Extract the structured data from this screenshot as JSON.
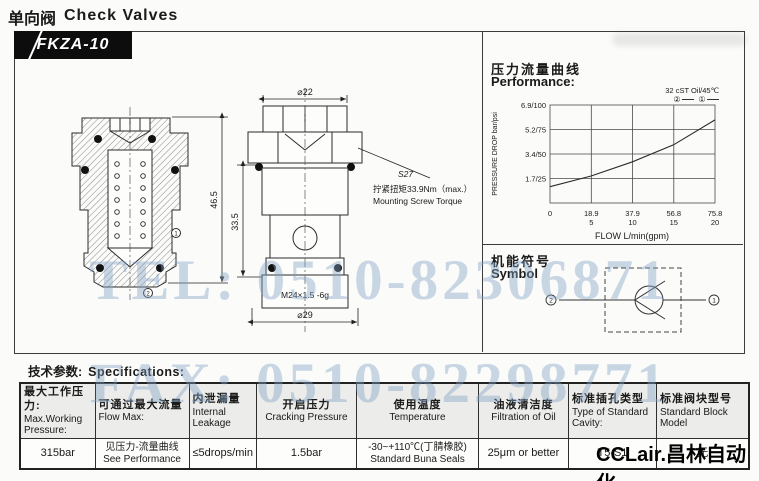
{
  "page": {
    "title_zh": "单向阀",
    "title_en": "Check Valves",
    "model": "FKZA-10"
  },
  "watermarks": {
    "tel": "TEL: 0510-82306871",
    "fax": "FAX: 0510-82298771",
    "color": "#80a3c5"
  },
  "logo_text": "CCLair.昌林自动化",
  "drawing": {
    "dim_dia_top": "⌀22",
    "dim_overall_height": "46.5",
    "dim_body_height": "33.5",
    "dim_thread": "M24×1.5 -6g",
    "dim_dia_bottom": "⌀29",
    "wrench_size": "S27",
    "torque_zh": "拧紧扭矩33.9Nm（max.）",
    "torque_en": "Mounting Screw Torque",
    "port1": "1",
    "port2": "2"
  },
  "performance": {
    "title_zh": "压力流量曲线",
    "title_en": "Performance:"
  },
  "chart_data": {
    "type": "line",
    "title": "32 cST Oil/45℃",
    "legend": [
      {
        "name": "②"
      },
      {
        "name": "①"
      }
    ],
    "xlabel": "FLOW L/min(gpm)",
    "ylabel": "PRESSURE DROP bar/psi",
    "xlim": [
      0,
      75.8
    ],
    "ylim": [
      0,
      6.9
    ],
    "grid": true,
    "y_ticks": [
      "6.9/100",
      "5.2/75",
      "3.4/50",
      "1.7/25"
    ],
    "x_ticks": [
      {
        "lmin": "0",
        "gpm": ""
      },
      {
        "lmin": "18.9",
        "gpm": "5"
      },
      {
        "lmin": "37.9",
        "gpm": "10"
      },
      {
        "lmin": "56.8",
        "gpm": "15"
      },
      {
        "lmin": "75.8",
        "gpm": "20"
      }
    ],
    "series": [
      {
        "name": "①②",
        "points": [
          [
            0,
            1.15
          ],
          [
            18.9,
            1.9
          ],
          [
            37.9,
            2.9
          ],
          [
            56.8,
            4.1
          ],
          [
            75.8,
            5.85
          ]
        ]
      }
    ]
  },
  "symbol": {
    "title_zh": "机能符号",
    "title_en": "Symbol",
    "port_left": "2",
    "port_right": "1"
  },
  "specs": {
    "heading_zh": "技术参数:",
    "heading_en": "Specifications:",
    "columns": [
      {
        "zh": "最大工作压力:",
        "en": "Max.Working Pressure:"
      },
      {
        "zh": "可通过最大流量",
        "en": "Flow Max:"
      },
      {
        "zh": "内泄漏量",
        "en": "Internal Leakage"
      },
      {
        "zh": "开启压力",
        "en": "Cracking Pressure"
      },
      {
        "zh": "使用温度",
        "en": "Temperature"
      },
      {
        "zh": "油液清洁度",
        "en": "Filtration of Oil"
      },
      {
        "zh": "标准插孔类型",
        "en": "Type of Standard Cavity:"
      },
      {
        "zh": "标准阀块型号",
        "en": "Standard Block Model"
      }
    ],
    "values": [
      {
        "line1": "315bar",
        "line2": ""
      },
      {
        "line1": "见压力-流量曲线",
        "line2": "See Performance"
      },
      {
        "line1": "≤5drops/min",
        "line2": ""
      },
      {
        "line1": "1.5bar",
        "line2": ""
      },
      {
        "line1": "-30~+110℃(丁腈橡胶)",
        "line2": "Standard Buna Seals"
      },
      {
        "line1": "25μm or better",
        "line2": ""
      },
      {
        "line1": "T5-S1",
        "line2": ""
      },
      {
        "line1": "无",
        "line2": ""
      }
    ]
  }
}
